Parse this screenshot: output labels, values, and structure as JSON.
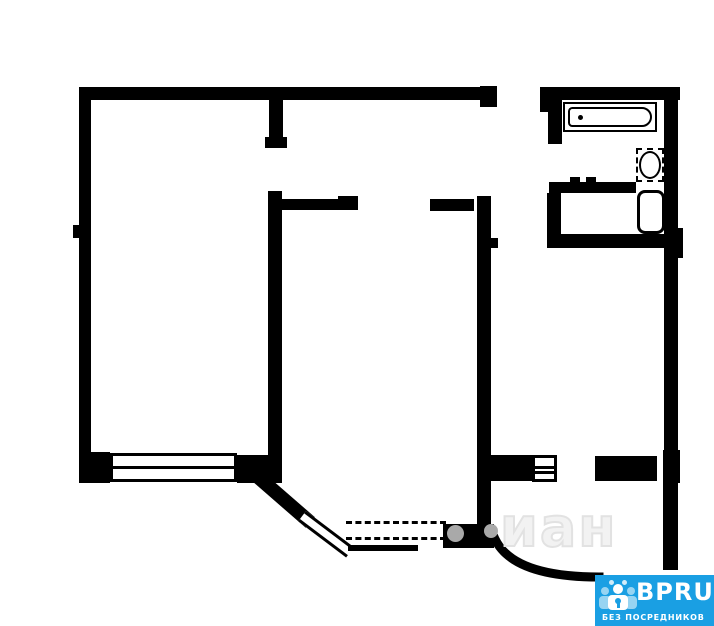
{
  "colors": {
    "wall": "#000000",
    "background": "#ffffff",
    "watermark_gray": "#e2e2e2",
    "hinge_dot_gray": "#a9a9a9",
    "logo_blue": "#1A9FE3",
    "logo_text": "#ffffff"
  },
  "watermark": {
    "text": "иан"
  },
  "logo": {
    "name": "BPRU",
    "tagline": "БЕЗ ПОСРЕДНИКОВ",
    "icon": "people-group-with-keyhole-icon"
  },
  "plan": {
    "type": "apartment-floor-plan",
    "fixtures": [
      "bathtub",
      "sink",
      "toilet",
      "ventilation-box",
      "window-left-room",
      "bay-window",
      "entrance-door-arc",
      "door-hinge-dot-left",
      "door-hinge-dot-right"
    ]
  }
}
